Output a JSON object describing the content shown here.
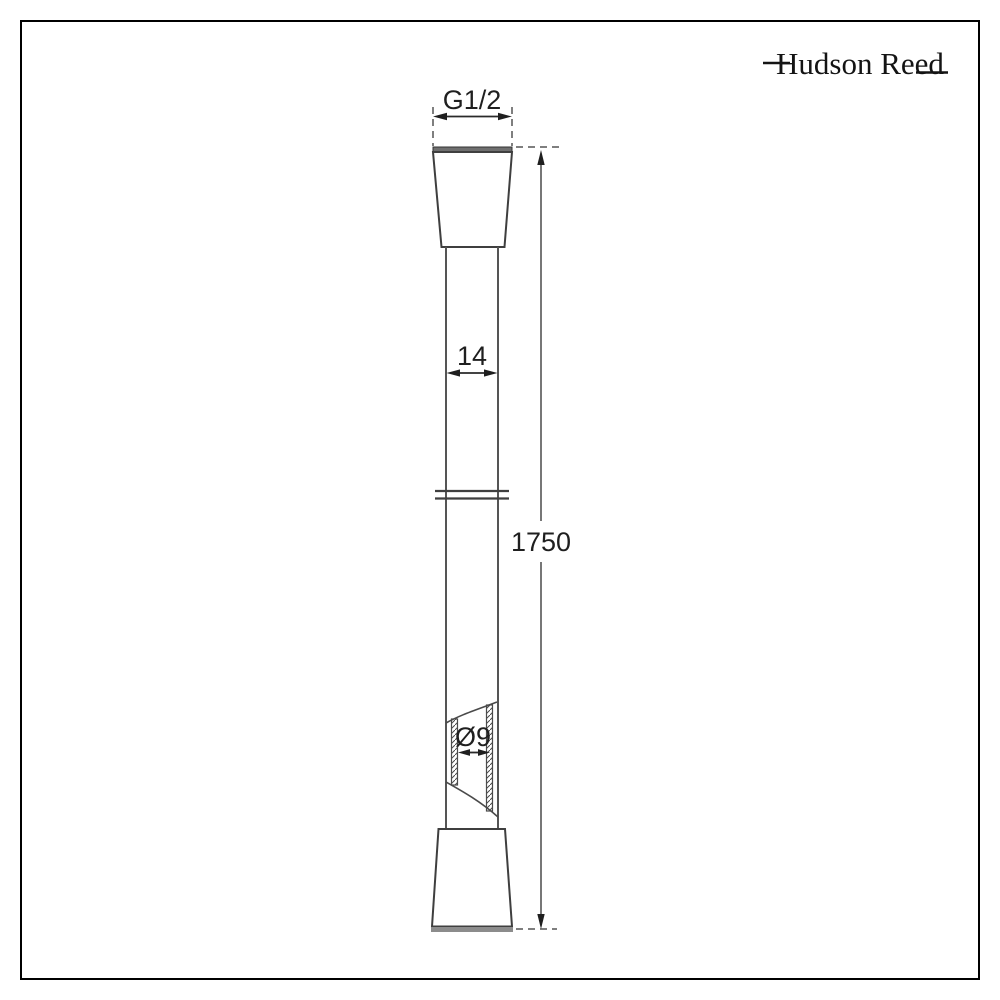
{
  "brand": {
    "name": "Hudson Reed"
  },
  "drawing": {
    "dimensions": {
      "thread_size": "G1/2",
      "outer_diameter": "14",
      "length": "1750",
      "inner_diameter": "Ø9"
    },
    "colors": {
      "background": "#ffffff",
      "border": "#000000",
      "line": "#4a4a4a",
      "text": "#1f1f1f",
      "connector_top_band": "#6f6f6f",
      "connector_base": "#8c8c8c"
    }
  }
}
